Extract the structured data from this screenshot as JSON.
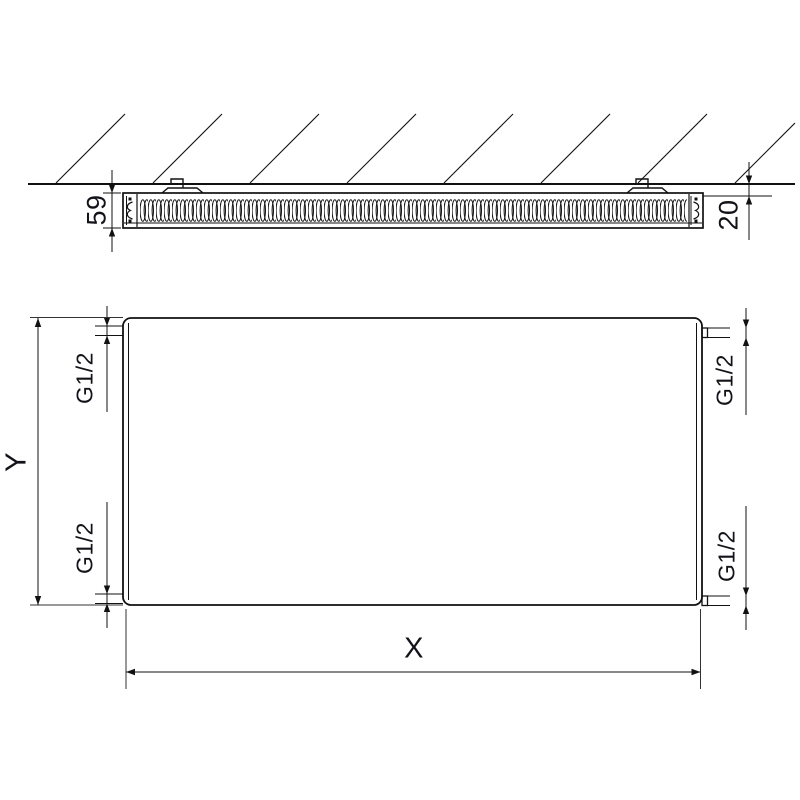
{
  "labels": {
    "depth": "59",
    "wall_gap": "20",
    "height": "Y",
    "width": "X",
    "conn_top_left": "G1/2",
    "conn_bottom_left": "G1/2",
    "conn_top_right": "G1/2",
    "conn_bottom_right": "G1/2"
  },
  "colors": {
    "line": "#111111",
    "background": "#ffffff"
  }
}
